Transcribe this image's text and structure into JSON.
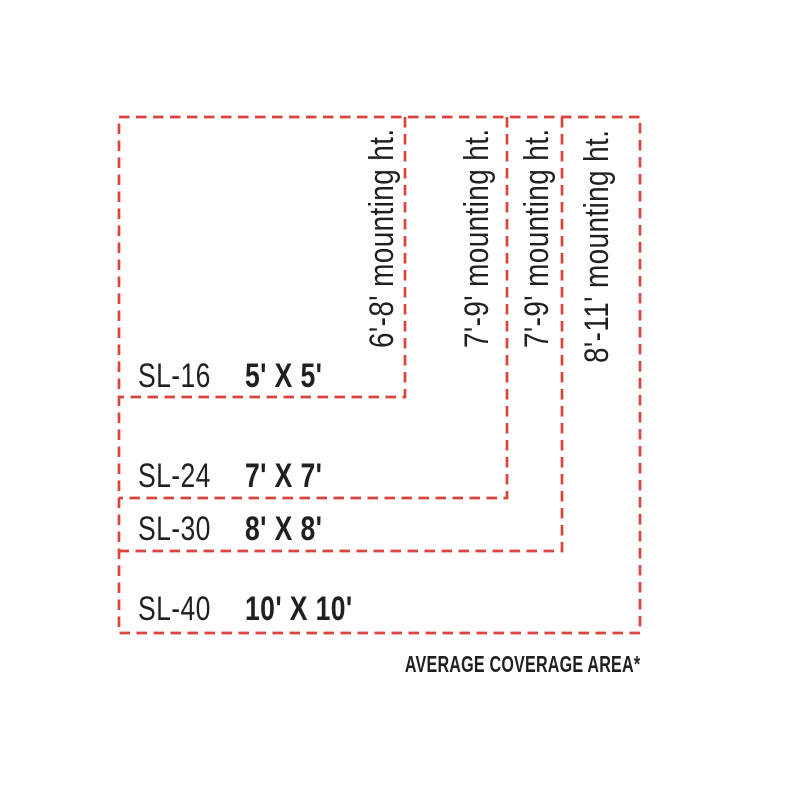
{
  "diagram": {
    "caption": "AVERAGE COVERAGE AREA*",
    "colors": {
      "accent": "#d9453c",
      "ink": "#231f20",
      "background": "#ffffff"
    },
    "products": [
      {
        "model": "SL-16",
        "coverage": "5' X 5'",
        "mounting_height": "6'-8' mounting ht."
      },
      {
        "model": "SL-24",
        "coverage": "7' X 7'",
        "mounting_height": "7'-9' mounting ht."
      },
      {
        "model": "SL-30",
        "coverage": "8' X 8'",
        "mounting_height": "7'-9' mounting ht."
      },
      {
        "model": "SL-40",
        "coverage": "10' X 10'",
        "mounting_height": "8'-11' mounting ht."
      }
    ]
  }
}
